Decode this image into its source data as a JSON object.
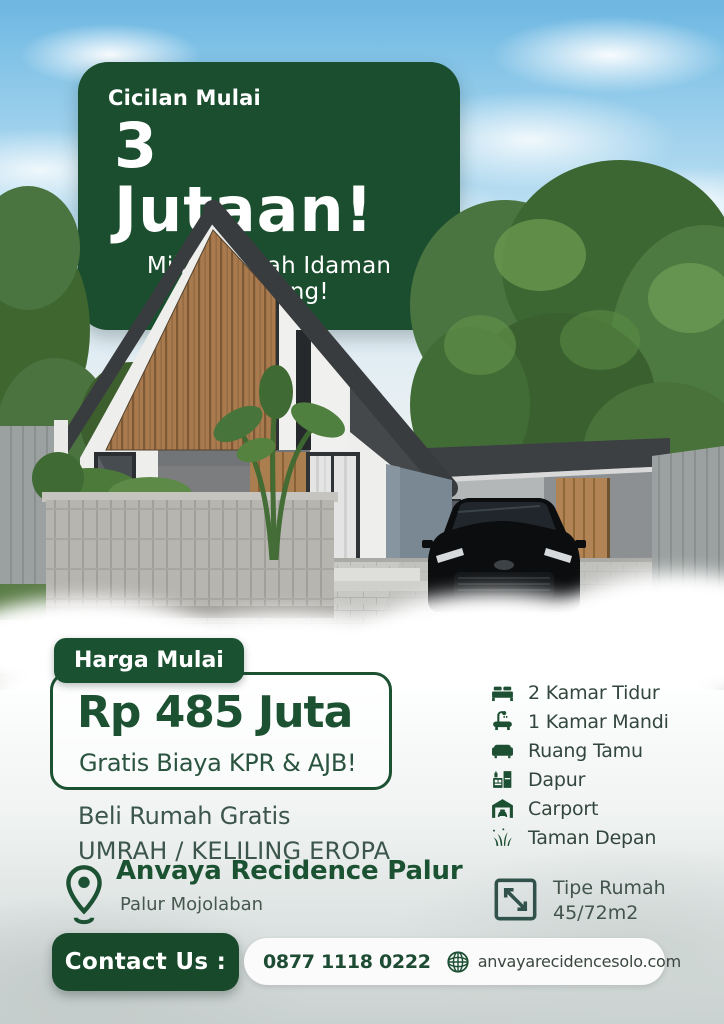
{
  "offer_box": {
    "kicker": "Cicilan Mulai",
    "headline": "3 Jutaan!",
    "tagline": "Miliki Rumah Idaman Sekarang!"
  },
  "pricing": {
    "badge": "Harga Mulai",
    "price": "Rp 485 Juta",
    "note": "Gratis Biaya KPR & AJB!"
  },
  "promo": {
    "line1": "Beli Rumah Gratis",
    "line2": "UMRAH / KELILING EROPA"
  },
  "project": {
    "name": "Anvaya Recidence Palur",
    "location": "Palur Mojolaban"
  },
  "features": [
    {
      "icon": "bed-icon",
      "label": "2 Kamar Tidur"
    },
    {
      "icon": "bath-icon",
      "label": "1 Kamar Mandi"
    },
    {
      "icon": "sofa-icon",
      "label": "Ruang Tamu"
    },
    {
      "icon": "kitchen-icon",
      "label": "Dapur"
    },
    {
      "icon": "carport-icon",
      "label": "Carport"
    },
    {
      "icon": "garden-icon",
      "label": "Taman Depan"
    }
  ],
  "house_type": {
    "icon": "measure-icon",
    "label": "Tipe Rumah",
    "value": "45/72m2"
  },
  "contact": {
    "button_label": "Contact Us :",
    "phone": "0877 1118 0222",
    "website": "anvayarecidencesolo.com"
  },
  "colors": {
    "primary_green": "#1a4e2e",
    "badge_green": "#1a5130",
    "text_green": "#1c5232",
    "muted_green": "#3c564c",
    "icon_green": "#1d4f33"
  }
}
